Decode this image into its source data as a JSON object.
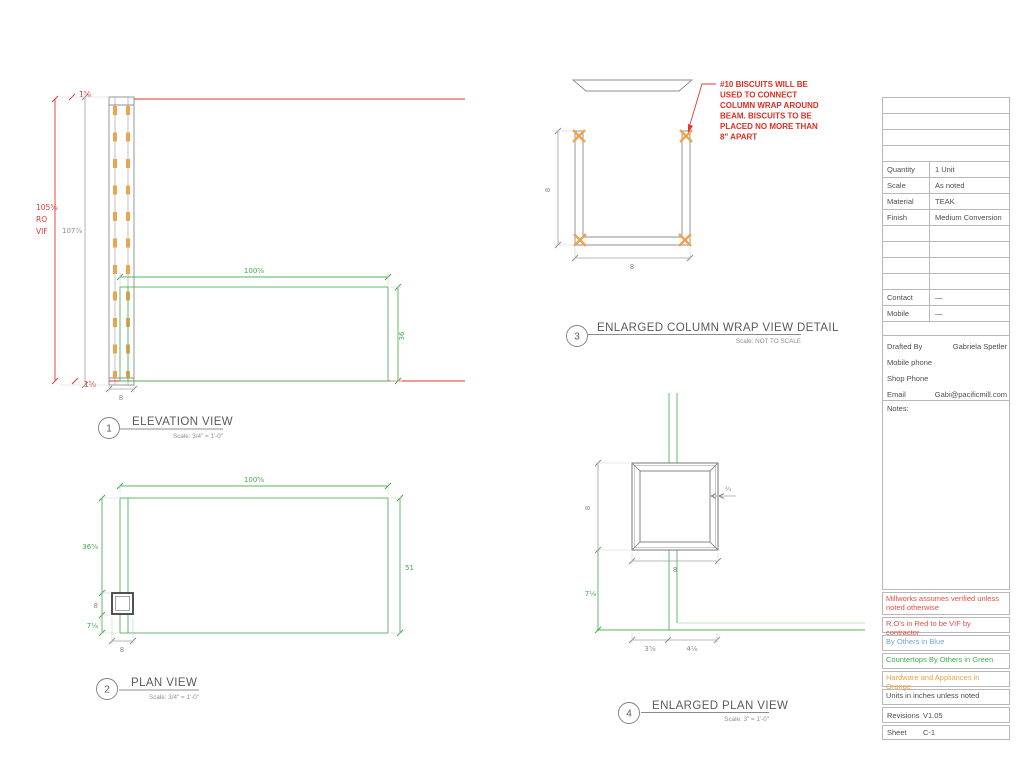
{
  "colors": {
    "red": "#e0392e",
    "green": "#3fae49",
    "blue": "#6fa8dc",
    "orange": "#f0a245",
    "gray_line": "#8c8c8c"
  },
  "views": {
    "elevation": {
      "number": "1",
      "title": "ELEVATION VIEW",
      "scale": "Scale: 3/4\" = 1'-0\"",
      "dims": {
        "cap": "1⅝",
        "cap_bottom": "1⅝",
        "ro_height": "105⅝",
        "ro_line2": "RO",
        "ro_line3": "VIF",
        "overall_height": "107⅞",
        "counter_width": "100⅝",
        "counter_height": "36",
        "column_width": "8"
      }
    },
    "plan": {
      "number": "2",
      "title": "PLAN VIEW",
      "scale": "Scale: 3/4\" = 1'-0\"",
      "dims": {
        "width": "100⅝",
        "left_upper": "36⅝",
        "column": "8",
        "left_lower": "7⅛",
        "depth_right": "51",
        "column_width": "8"
      }
    },
    "column_wrap": {
      "number": "3",
      "title": "ENLARGED COLUMN WRAP VIEW DETAIL",
      "scale": "Scale: NOT TO SCALE",
      "dims": {
        "height": "8",
        "width": "8"
      },
      "note_lines": [
        "#10 BISCUITS WILL BE",
        "USED TO  CONNECT",
        "COLUMN WRAP AROUND",
        "BEAM. BISCUITS TO BE",
        "PLACED NO MORE THAN",
        "8\" APART"
      ]
    },
    "enlarged_plan": {
      "number": "4",
      "title": "ENLARGED PLAN VIEW",
      "scale": "Scale: 3\" = 1'-0\"",
      "dims": {
        "height": "8",
        "width": "8",
        "offset_left": "3⅝",
        "offset_right": "4⅛",
        "counter_overhang": "7⅛",
        "thickness": "¾"
      }
    }
  },
  "title_block": {
    "specs": [
      {
        "label": "Quantity",
        "value": "1 Unit"
      },
      {
        "label": "Scale",
        "value": "As noted"
      },
      {
        "label": "Material",
        "value": "TEAK"
      },
      {
        "label": "Finish",
        "value": "Medium Conversion"
      }
    ],
    "contact": [
      {
        "label": "Contact",
        "value": "—"
      },
      {
        "label": "Mobile",
        "value": "—"
      }
    ],
    "drafted": [
      {
        "label": "Drafted By",
        "value": "Gabriela Spetler"
      },
      {
        "label": "Mobile phone",
        "value": ""
      },
      {
        "label": "Shop Phone",
        "value": ""
      },
      {
        "label": "Email",
        "value": "Gabi@pacificmill.com"
      }
    ],
    "notes_label": "Notes:",
    "legend": [
      {
        "text": "Millworks assumes verified unless noted otherwise",
        "color": "red"
      },
      {
        "text": "R.O's in Red to be VIF by contractor",
        "color": "red"
      },
      {
        "text": "By Others in Blue",
        "color": "blue"
      },
      {
        "text": "Countertops By Others in Green",
        "color": "green"
      },
      {
        "text": "Hardware and Appliances in Orange",
        "color": "orange"
      },
      {
        "text": "Units in inches unless noted",
        "color": "dark"
      }
    ],
    "revisions": {
      "label": "Revisions",
      "value": "V1.05"
    },
    "sheet": {
      "label": "Sheet",
      "value": "C-1"
    }
  }
}
